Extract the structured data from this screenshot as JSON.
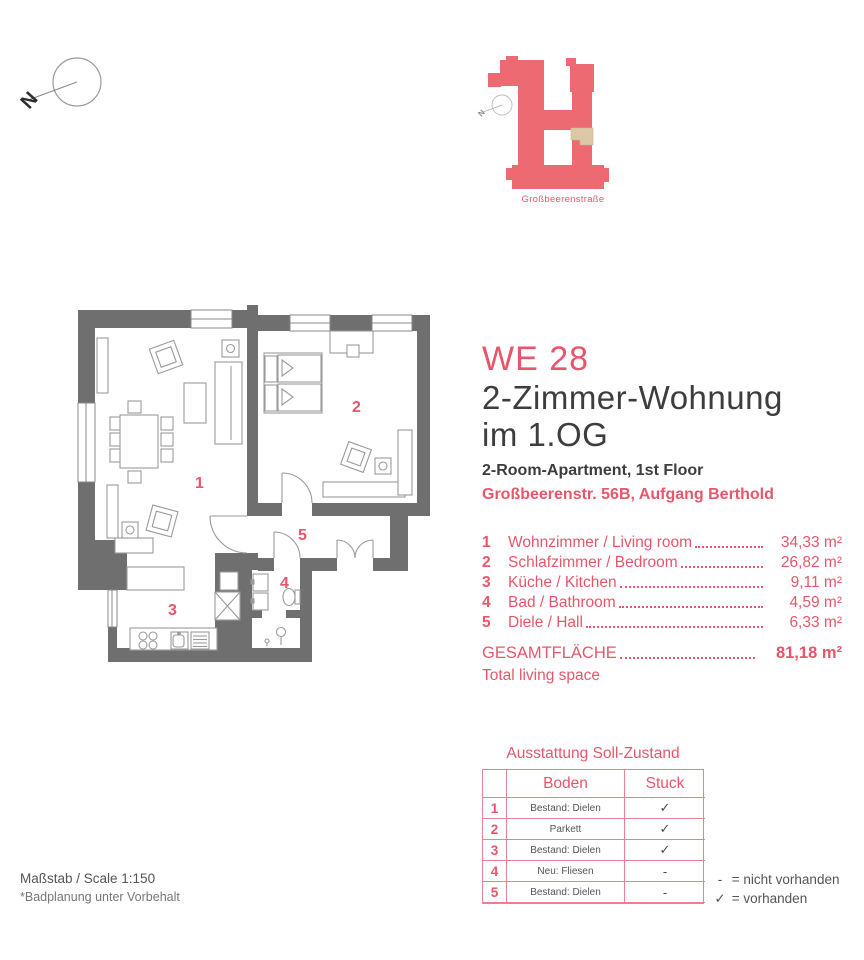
{
  "colors": {
    "accent": "#e8566b",
    "wall_gray": "#6f6f6f",
    "site_pink": "#ee6a72",
    "unit_beige": "#dcc9a4",
    "text_dark": "#3d3d3d"
  },
  "north": {
    "label": "N"
  },
  "site_plan": {
    "north_label": "N",
    "street_label": "Großbeerenstraße"
  },
  "title": {
    "unit_id": "WE 28",
    "line1": "2-Zimmer-Wohnung",
    "line2": "im 1.OG",
    "subtitle_en": "2-Room-Apartment, 1st Floor",
    "address": "Großbeerenstr. 56B, Aufgang Berthold"
  },
  "rooms": [
    {
      "nr": "1",
      "name": "Wohnzimmer / Living room",
      "area": "34,33 m²"
    },
    {
      "nr": "2",
      "name": "Schlafzimmer / Bedroom",
      "area": "26,82 m²"
    },
    {
      "nr": "3",
      "name": "Küche  / Kitchen",
      "area": "9,11 m²"
    },
    {
      "nr": "4",
      "name": "Bad / Bathroom",
      "area": "4,59 m²"
    },
    {
      "nr": "5",
      "name": "Diele / Hall",
      "area": "6,33 m²"
    }
  ],
  "total": {
    "label": "GESAMTFLÄCHE",
    "sublabel": "Total living space",
    "value": "81,18 m²"
  },
  "equipment": {
    "heading": "Ausstattung Soll-Zustand",
    "col_boden": "Boden",
    "col_stuck": "Stuck",
    "rows": [
      {
        "nr": "1",
        "boden": "Bestand: Dielen",
        "stuck": "✓"
      },
      {
        "nr": "2",
        "boden": "Parkett",
        "stuck": "✓"
      },
      {
        "nr": "3",
        "boden": "Bestand: Dielen",
        "stuck": "✓"
      },
      {
        "nr": "4",
        "boden": "Neu: Fliesen",
        "stuck": "-"
      },
      {
        "nr": "5",
        "boden": "Bestand: Dielen",
        "stuck": "-"
      }
    ],
    "legend": [
      {
        "symbol": "-",
        "text": "= nicht vorhanden"
      },
      {
        "symbol": "✓",
        "text": "= vorhanden"
      }
    ]
  },
  "plan": {
    "labels": [
      "1",
      "2",
      "3",
      "4",
      "5"
    ]
  },
  "footer": {
    "scale": "Maßstab / Scale 1:150",
    "note": "*Badplanung unter Vorbehalt"
  }
}
